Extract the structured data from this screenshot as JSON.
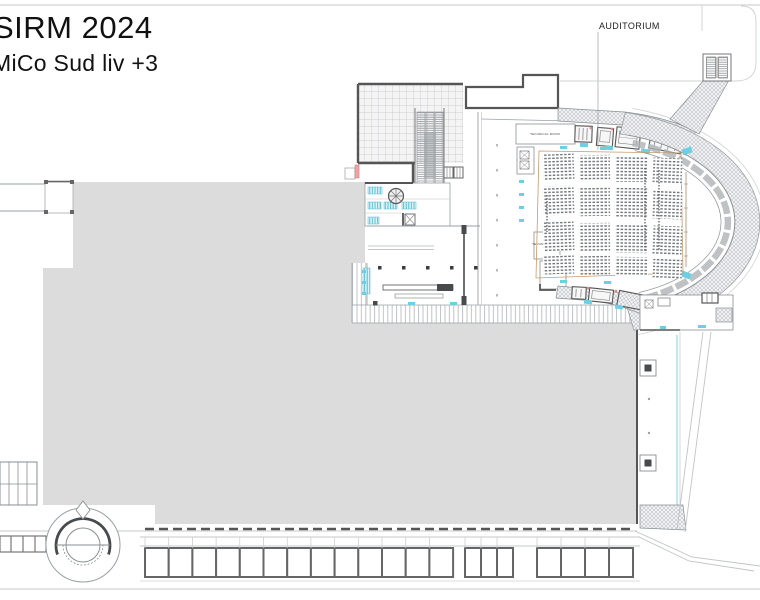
{
  "title": {
    "line1": "SIRM 2024",
    "line2": "MiCo Sud liv +3"
  },
  "labels": {
    "auditorium": "AUDITORIUM",
    "technical_room_upper": "TECHNICAL ROOM",
    "technical_room_lower": "TECHNICAL ROOM"
  },
  "colors": {
    "background": "#ffffff",
    "floor_gray": "#dcdcdc",
    "line_dark": "#555555",
    "line_mid": "#888c8f",
    "line_light": "#b5b9bc",
    "accent_cyan": "#6fcfe2",
    "accent_tan": "#c49a6c",
    "accent_red": "#e08a8a"
  },
  "plan": {
    "bottom_bays": {
      "y": 548,
      "height": 29,
      "groups": [
        {
          "x": 145,
          "count": 13,
          "bay_width": 23.7
        },
        {
          "x": 465,
          "count": 3,
          "bay_width": 16
        },
        {
          "x": 537,
          "count": 4,
          "bay_width": 24
        }
      ]
    },
    "foyer_columns": {
      "y": 266,
      "size": 3.5,
      "xs": [
        378,
        402,
        426,
        450,
        474
      ]
    },
    "auditorium_seating": {
      "columns": [
        {
          "x": 543,
          "w": 31,
          "dy": 0,
          "rot": -2.0
        },
        {
          "x": 579,
          "w": 31,
          "dy": 1,
          "rot": -0.7
        },
        {
          "x": 615,
          "w": 33,
          "dy": 2,
          "rot": 0.7
        },
        {
          "x": 653,
          "w": 29,
          "dy": 4,
          "rot": 2.2
        }
      ],
      "rows": [
        {
          "y": 154,
          "h": 26
        },
        {
          "y": 186,
          "h": 29
        },
        {
          "y": 222,
          "h": 29
        },
        {
          "y": 255,
          "h": 19
        }
      ]
    }
  }
}
